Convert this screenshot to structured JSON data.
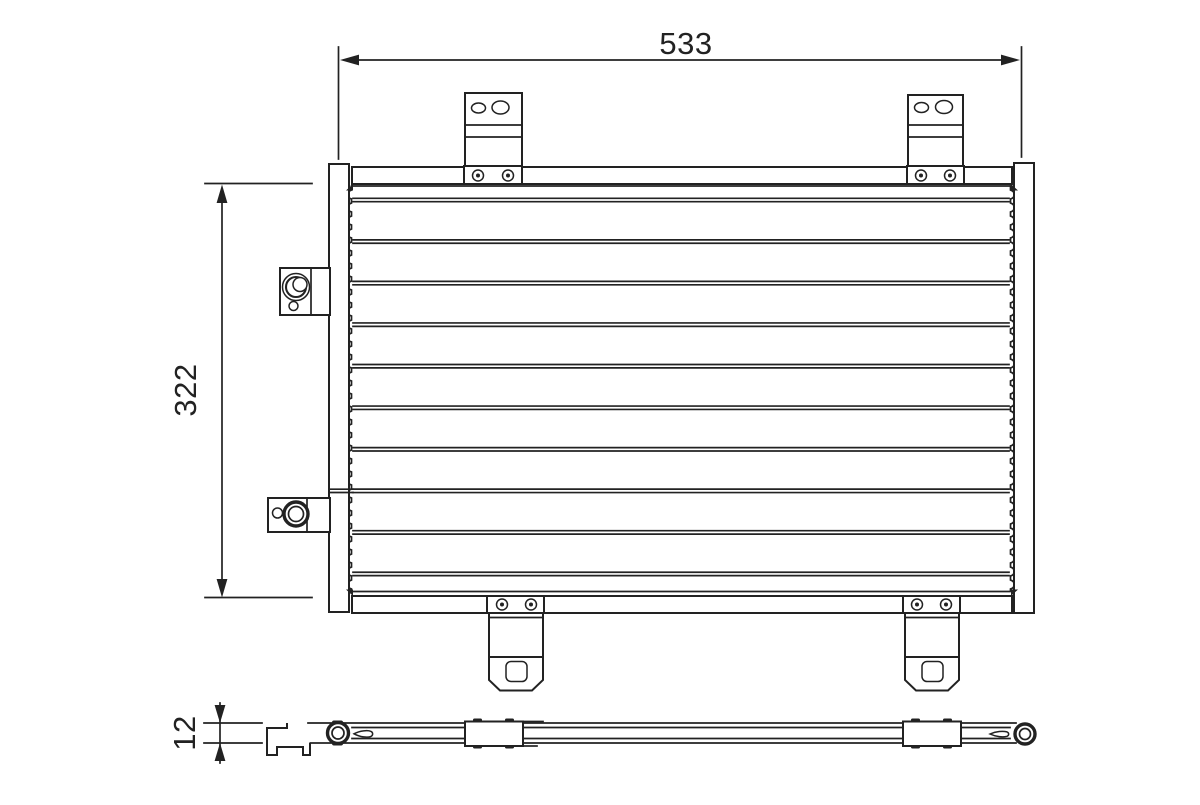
{
  "drawing": {
    "background_color": "#ffffff",
    "line_color": "#222222",
    "dimensions": {
      "width_label": "533",
      "height_label": "322",
      "depth_label": "12"
    }
  }
}
